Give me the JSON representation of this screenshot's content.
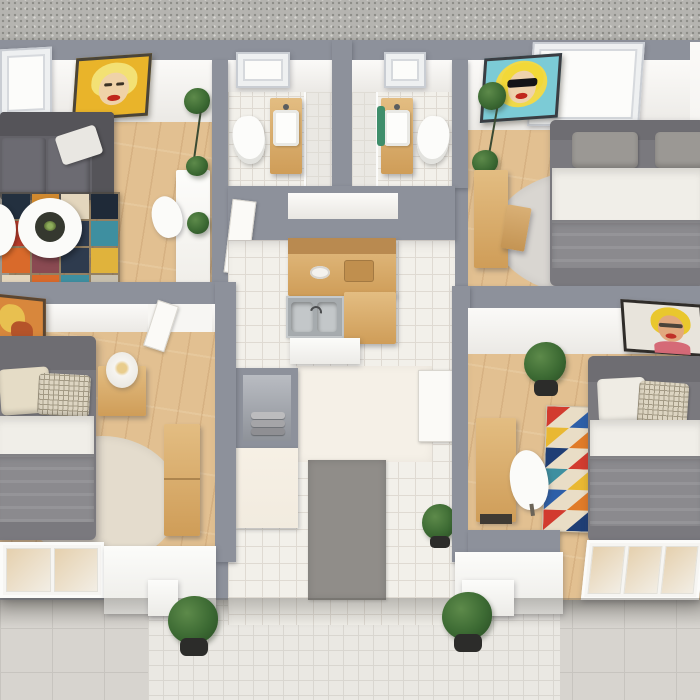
{
  "scene": {
    "title": "Top-down 3D render of an apartment floor plan",
    "colors": {
      "concrete": "#b5b4b0",
      "wall": "#8d919b",
      "wood_floor": "#e2c091",
      "tile": "#f2f0ea",
      "grout": "#dfdad2",
      "terrace": "#d7d4cf",
      "terrace_grout": "#c7c4bf",
      "pad": "#eae8e3",
      "pad_grout": "#d9d6d0",
      "sofa": "#636268",
      "sofa_dark": "#555459",
      "sofa_pillow": "#e9e7e2",
      "bed_frame": "#7a797e",
      "headboard": "#6e6d72",
      "blanket": "#8b8a8e",
      "duvet": "#f0eee8",
      "pillow_gray": "#9b9894",
      "pillow_beige": "#e5dcc6",
      "check_base": "#ddd5c2",
      "check_line": "#a39a85",
      "rug_round_gray": "#d9d6d1",
      "rug_round_beige": "#e4dccd",
      "wood_furn": "#cf9d58",
      "wood_furn_light": "#e3bd82",
      "steel": "#a6abae",
      "mat": "#908d89",
      "cream_cab": "#f2ebdf",
      "closet_inner_a": "#b9bcc2",
      "closet_inner_b": "#8e9299",
      "towel_a": "#bcbcbe",
      "towel_b": "#a5a5a8",
      "towel_c": "#8f8f93",
      "plant": "#3c6a33",
      "plant_dark": "#294d24",
      "pot": "#2c2c2a",
      "fixture": "#fcfcfa",
      "tri_base": "#e9ddc6",
      "p1_frame": "#4a4438",
      "p1_bg": "#e9b42a",
      "p1_hair": "#f3e174",
      "p1_skin": "#efd2a8",
      "p1_lips": "#c0271c",
      "p2_frame": "#3a3d42",
      "p2_bg": "#7ccbd6",
      "p2_halo": "#f0d94a",
      "p2_hair": "#f2d838",
      "p2_skin": "#eed2ac",
      "p2_glasses": "#141417",
      "p2_lips": "#c0271c",
      "p3_frame": "#5a4632",
      "p3_bg": "#d8873c",
      "p3_accent": "#e8c050",
      "p3_accent2": "#b5542a",
      "p4_frame": "#2f2c29",
      "p4_bg": "#e8e4dc",
      "p4_hair": "#e9c72e",
      "p4_skin": "#e2a87e",
      "p4_lips": "#c03028",
      "p4_pink": "#d56a77"
    },
    "living_rug_tiles": [
      "#23303f",
      "#d0892f",
      "#e3d6bd",
      "#1f2a38",
      "#c23f2e",
      "#e3d6bd",
      "#2e3b4e",
      "#3e8fa0",
      "#d96a2b",
      "#8a4a52",
      "#2e3b4e",
      "#e0b33c",
      "#e3d6bd",
      "#d96a2b",
      "#3e8fa0",
      "#c8c0ae"
    ],
    "triangle_rug_colors": [
      "#d23b2f",
      "#2d5fa8",
      "#e9b832",
      "#e07b28",
      "#1f3e75",
      "#d23b2f",
      "#3e8fa0",
      "#e9b832",
      "#2d5fa8",
      "#e07b28",
      "#d23b2f",
      "#1f3e75"
    ],
    "rooms": {
      "living_room": {
        "name": "Living room",
        "items": [
          "gray sofa with white throw pillow",
          "patchwork rug",
          "two round white coffee tables",
          "white dining table",
          "white chair",
          "tall plant",
          "yellow Marilyn pop-art painting",
          "corner windows"
        ]
      },
      "bathroom_left": {
        "name": "Bathroom 1",
        "items": [
          "toilet",
          "wood vanity with white sink",
          "tiled shower",
          "window"
        ]
      },
      "bathroom_right": {
        "name": "Bathroom 2",
        "items": [
          "toilet",
          "wood vanity with white sink and green accents",
          "tiled shower",
          "window"
        ]
      },
      "bedroom_top_right": {
        "name": "Bedroom top right",
        "items": [
          "gray double bed with white duvet",
          "round gray rug",
          "wood desk",
          "wood chair",
          "tall plant",
          "Marilyn-with-sunglasses pop-art painting",
          "large white window"
        ]
      },
      "bedroom_bottom_left": {
        "name": "Bedroom bottom left",
        "items": [
          "gray double bed with beige pillows",
          "wood nightstand",
          "white table lamp",
          "round beige rug",
          "wood bench",
          "orange pop-art painting (cut at edge)",
          "sliding glass door"
        ]
      },
      "kitchen": {
        "name": "Kitchen",
        "items": [
          "L-shaped wood counters",
          "stainless steel sink",
          "white lower cabinet"
        ]
      },
      "hallway": {
        "name": "Entry hallway",
        "items": [
          "white tiled floor",
          "gray doormat",
          "towel niche",
          "cream cabinet",
          "potted plant",
          "white interior door"
        ]
      },
      "bedroom_bottom_right": {
        "name": "Bedroom bottom right",
        "items": [
          "gray double bed with checkered pillow",
          "geometric triangle runner rug",
          "wood desk",
          "white shell chair",
          "potted plant",
          "pop-art portrait painting",
          "sliding glass doors"
        ]
      },
      "terrace": {
        "name": "Terrace",
        "items": [
          "large-tile patio",
          "small-tile pad",
          "two potted plants"
        ]
      }
    }
  }
}
